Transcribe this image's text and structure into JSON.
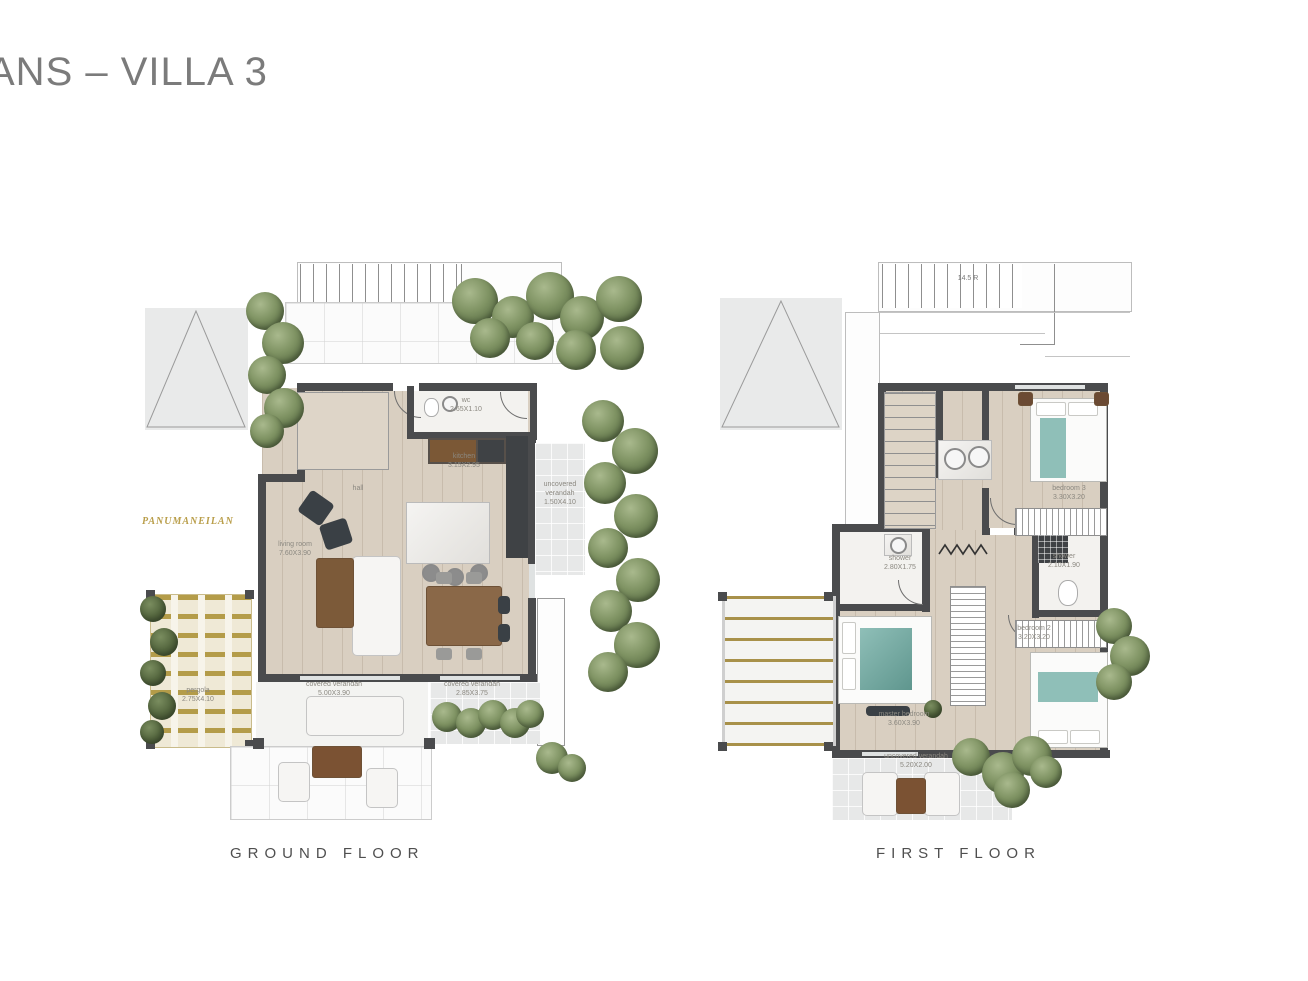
{
  "title": "ANS – VILLA 3",
  "captions": {
    "ground": "GROUND FLOOR",
    "first": "FIRST FLOOR"
  },
  "colors": {
    "wall": "#4a4b4d",
    "wood_floor": "#d9cfc1",
    "tile": "#e7e8e8",
    "tree_green": "#6d8054",
    "pergola_gold": "#b09a4b",
    "teal_accent": "#8fbfb8",
    "furniture_wood": "#7b5836",
    "label_text": "#8b8880",
    "title_text": "#7b7b7b"
  },
  "ground": {
    "watermark": "PANUMANEILAN",
    "rooms": {
      "wc": {
        "name": "wc",
        "dims": "2.65X1.10"
      },
      "kitchen": {
        "name": "kitchen",
        "dims": "3.15X2.95"
      },
      "hall": {
        "name": "hall",
        "dims": ""
      },
      "living": {
        "name": "living room",
        "dims": "7.60X3.90"
      },
      "uncovered": {
        "name": "uncovered verandah",
        "dims": "1.50X4.10"
      },
      "pergola": {
        "name": "pergola",
        "dims": "2.75X4.10"
      },
      "covered1": {
        "name": "covered verandah",
        "dims": "5.00X3.90"
      },
      "covered2": {
        "name": "covered verandah",
        "dims": "2.85X3.75"
      }
    }
  },
  "first": {
    "stair_note": "14.5 R",
    "rooms": {
      "bedroom3": {
        "name": "bedroom 3",
        "dims": "3.30X3.20"
      },
      "shower1": {
        "name": "shower",
        "dims": "2.80X1.75"
      },
      "shower2": {
        "name": "shower",
        "dims": "2.10X1.90"
      },
      "bedroom2": {
        "name": "bedroom 2",
        "dims": "3.20X3.20"
      },
      "master": {
        "name": "master bedroom",
        "dims": "3.60X3.90"
      },
      "uncovered": {
        "name": "uncovered verandah",
        "dims": "5.20X2.00"
      }
    }
  }
}
